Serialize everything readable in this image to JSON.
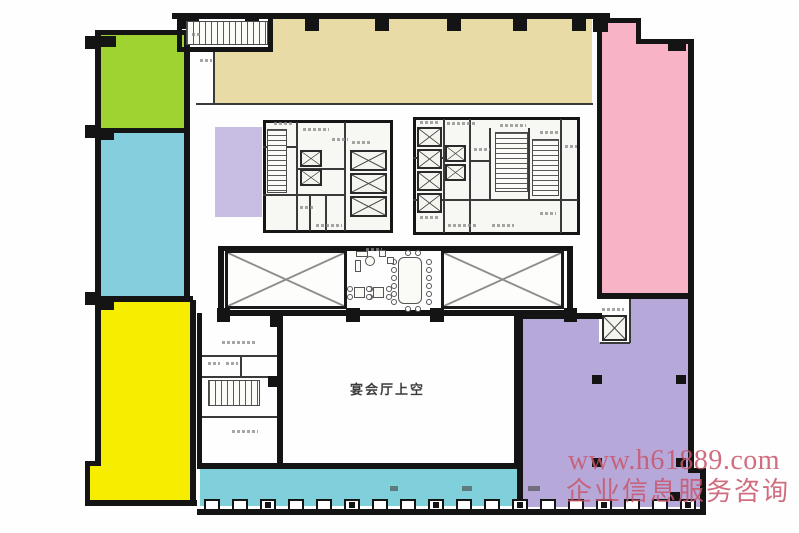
{
  "plan": {
    "type": "architectural-floor-plan",
    "wall_color": "#141414"
  },
  "labels": {
    "banquet_hall_void": "宴会厅上空"
  },
  "watermark": {
    "url_line": "www.h61889.com",
    "caption_line": "企业信息服务咨询",
    "color": "#c9566b"
  },
  "zones": {
    "northwest": {
      "color": "#9ed331"
    },
    "west": {
      "color": "#85cede"
    },
    "southwest": {
      "color": "#f7ed00"
    },
    "north": {
      "color": "#e8dba5"
    },
    "northeast": {
      "color": "#f8b4c6"
    },
    "inner_west": {
      "color": "#c8bee4"
    },
    "southeast": {
      "color": "#b6a9da"
    },
    "south_terrace": {
      "color": "#7fd0da"
    }
  }
}
